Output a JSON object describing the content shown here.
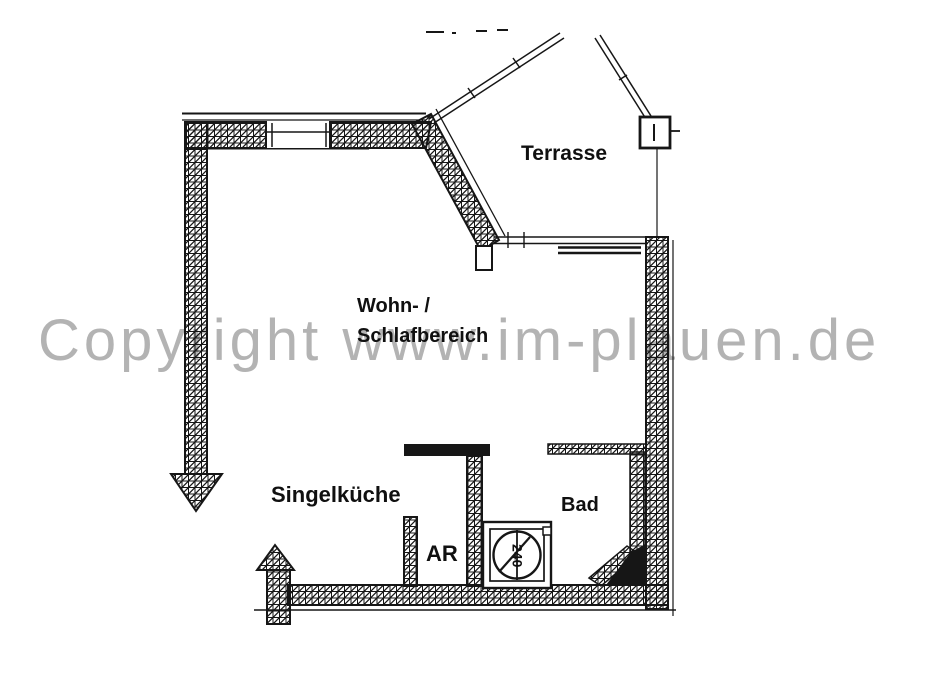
{
  "watermark": {
    "text": "Copyright www.im-plauen.de"
  },
  "rooms": {
    "terrace": {
      "label": "Terrasse"
    },
    "living": {
      "label_line1": "Wohn- /",
      "label_line2": "Schlafbereich"
    },
    "kitchen": {
      "label": "Singelküche"
    },
    "storage": {
      "label": "AR"
    },
    "bath": {
      "label": "Bad"
    }
  },
  "fixtures": {
    "shower_label": "240"
  },
  "colors": {
    "line": "#161616",
    "watermark": "#b3b3b3",
    "background": "#ffffff"
  }
}
